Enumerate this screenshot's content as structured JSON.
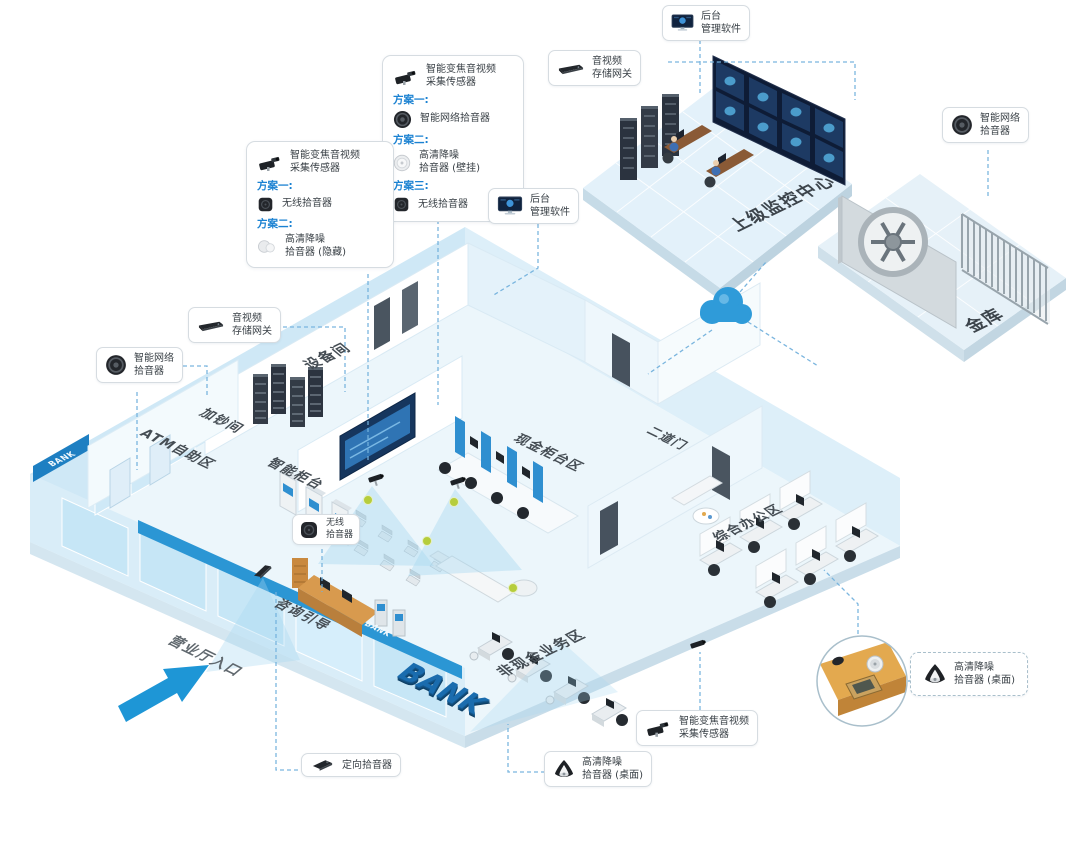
{
  "colors": {
    "accent_blue": "#2B96D4",
    "plan_label_blue": "#1B82D2",
    "mic_dot_green": "#B5CC3E",
    "wall_light_blue": "#CFE8F6",
    "bank_blue": "#1A6CAE",
    "screen_navy": "#0E1C36"
  },
  "plan_boxes": {
    "counter": {
      "device_line1": "智能变焦音视频",
      "device_line2": "采集传感器",
      "plan1_label": "方案一:",
      "plan1_item": "智能网络拾音器",
      "plan2_label": "方案二:",
      "plan2_item_line1": "高清降噪",
      "plan2_item_line2": "拾音器 (壁挂)",
      "plan3_label": "方案三:",
      "plan3_item": "无线拾音器"
    },
    "lobby": {
      "device_line1": "智能变焦音视频",
      "device_line2": "采集传感器",
      "plan1_label": "方案一:",
      "plan1_item": "无线拾音器",
      "plan2_label": "方案二:",
      "plan2_item_line1": "高清降噪",
      "plan2_item_line2": "拾音器 (隐藏)"
    }
  },
  "callouts": {
    "backend_top": {
      "line1": "后台",
      "line2": "管理软件"
    },
    "storage_top": {
      "line1": "音视频",
      "line2": "存储网关"
    },
    "net_right": {
      "line1": "智能网络",
      "line2": "拾音器"
    },
    "backend_mid": {
      "line1": "后台",
      "line2": "管理软件"
    },
    "storage_left": {
      "line1": "音视频",
      "line2": "存储网关"
    },
    "net_left": {
      "line1": "智能网络",
      "line2": "拾音器"
    },
    "wireless_floor": {
      "line1": "无线",
      "line2": "拾音器"
    },
    "directional": {
      "line1": "定向拾音器"
    },
    "desktop_bottom": {
      "line1": "高清降噪",
      "line2": "拾音器 (桌面)"
    },
    "zoom_bottom": {
      "line1": "智能变焦音视频",
      "line2": "采集传感器"
    },
    "desktop_right": {
      "line1": "高清降噪",
      "line2": "拾音器 (桌面)"
    }
  },
  "areas": {
    "monitoring_center": "上级监控中心",
    "vault": "金库",
    "equipment_room": "设备间",
    "cash_adding_room": "加钞间",
    "atm_area": "ATM自助区",
    "smart_counter": "智能柜台",
    "cash_counter_area": "现金柜台区",
    "second_door": "二道门",
    "office_area": "综合办公区",
    "non_cash_area": "非现金业务区",
    "consultation": "咨询引导",
    "entrance": "营业厅入口"
  },
  "signs": {
    "bank_3d": "BANK",
    "bank_band": "BANK",
    "bank_corner": "BANK"
  }
}
